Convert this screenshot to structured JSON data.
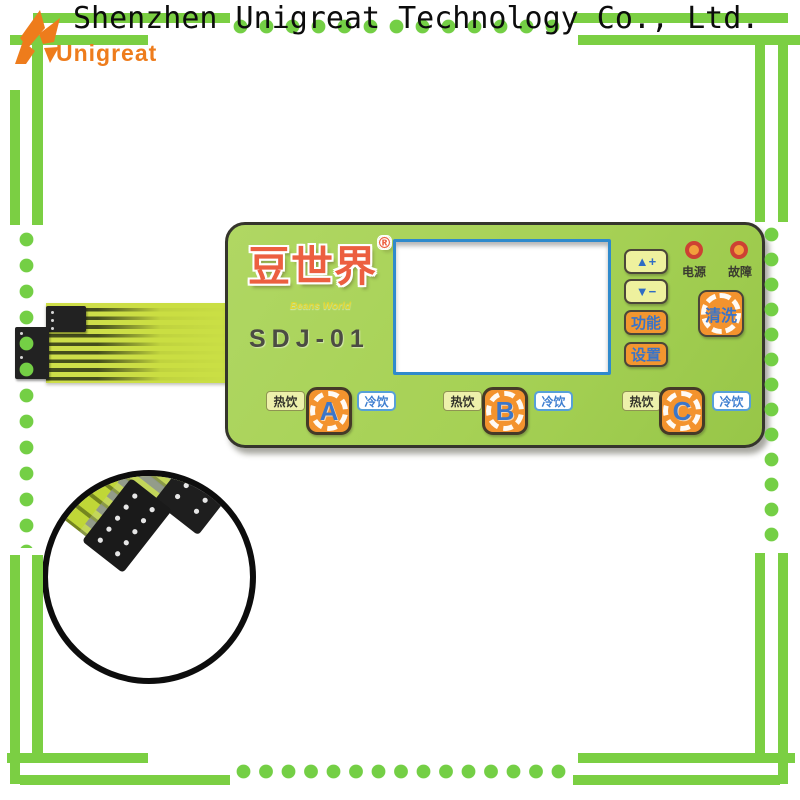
{
  "header": {
    "logo_text": "Unigreat",
    "company": "Shenzhen Unigreat Technology Co., Ltd."
  },
  "panel": {
    "brand": "豆世界",
    "brand_reg": "®",
    "brand_sub": "Beans World",
    "model": "SDJ-01",
    "keys": {
      "up": "▲+",
      "down": "▼−",
      "func": "功能",
      "set": "设置",
      "clean": "清洗"
    },
    "led_power": "电源",
    "led_fault": "故障",
    "groups": [
      {
        "hot": "热饮",
        "key": "A",
        "cold": "冷饮"
      },
      {
        "hot": "热饮",
        "key": "B",
        "cold": "冷饮"
      },
      {
        "hot": "热饮",
        "key": "C",
        "cold": "冷饮"
      }
    ]
  },
  "colors": {
    "frame_green": "#7bcf43",
    "panel_green": "#a6d155",
    "orange": "#f2912e",
    "blue": "#3b76c9",
    "brand_red": "#ec5f40",
    "led_red": "#cd4133",
    "ribbon_green": "#cadf45"
  }
}
